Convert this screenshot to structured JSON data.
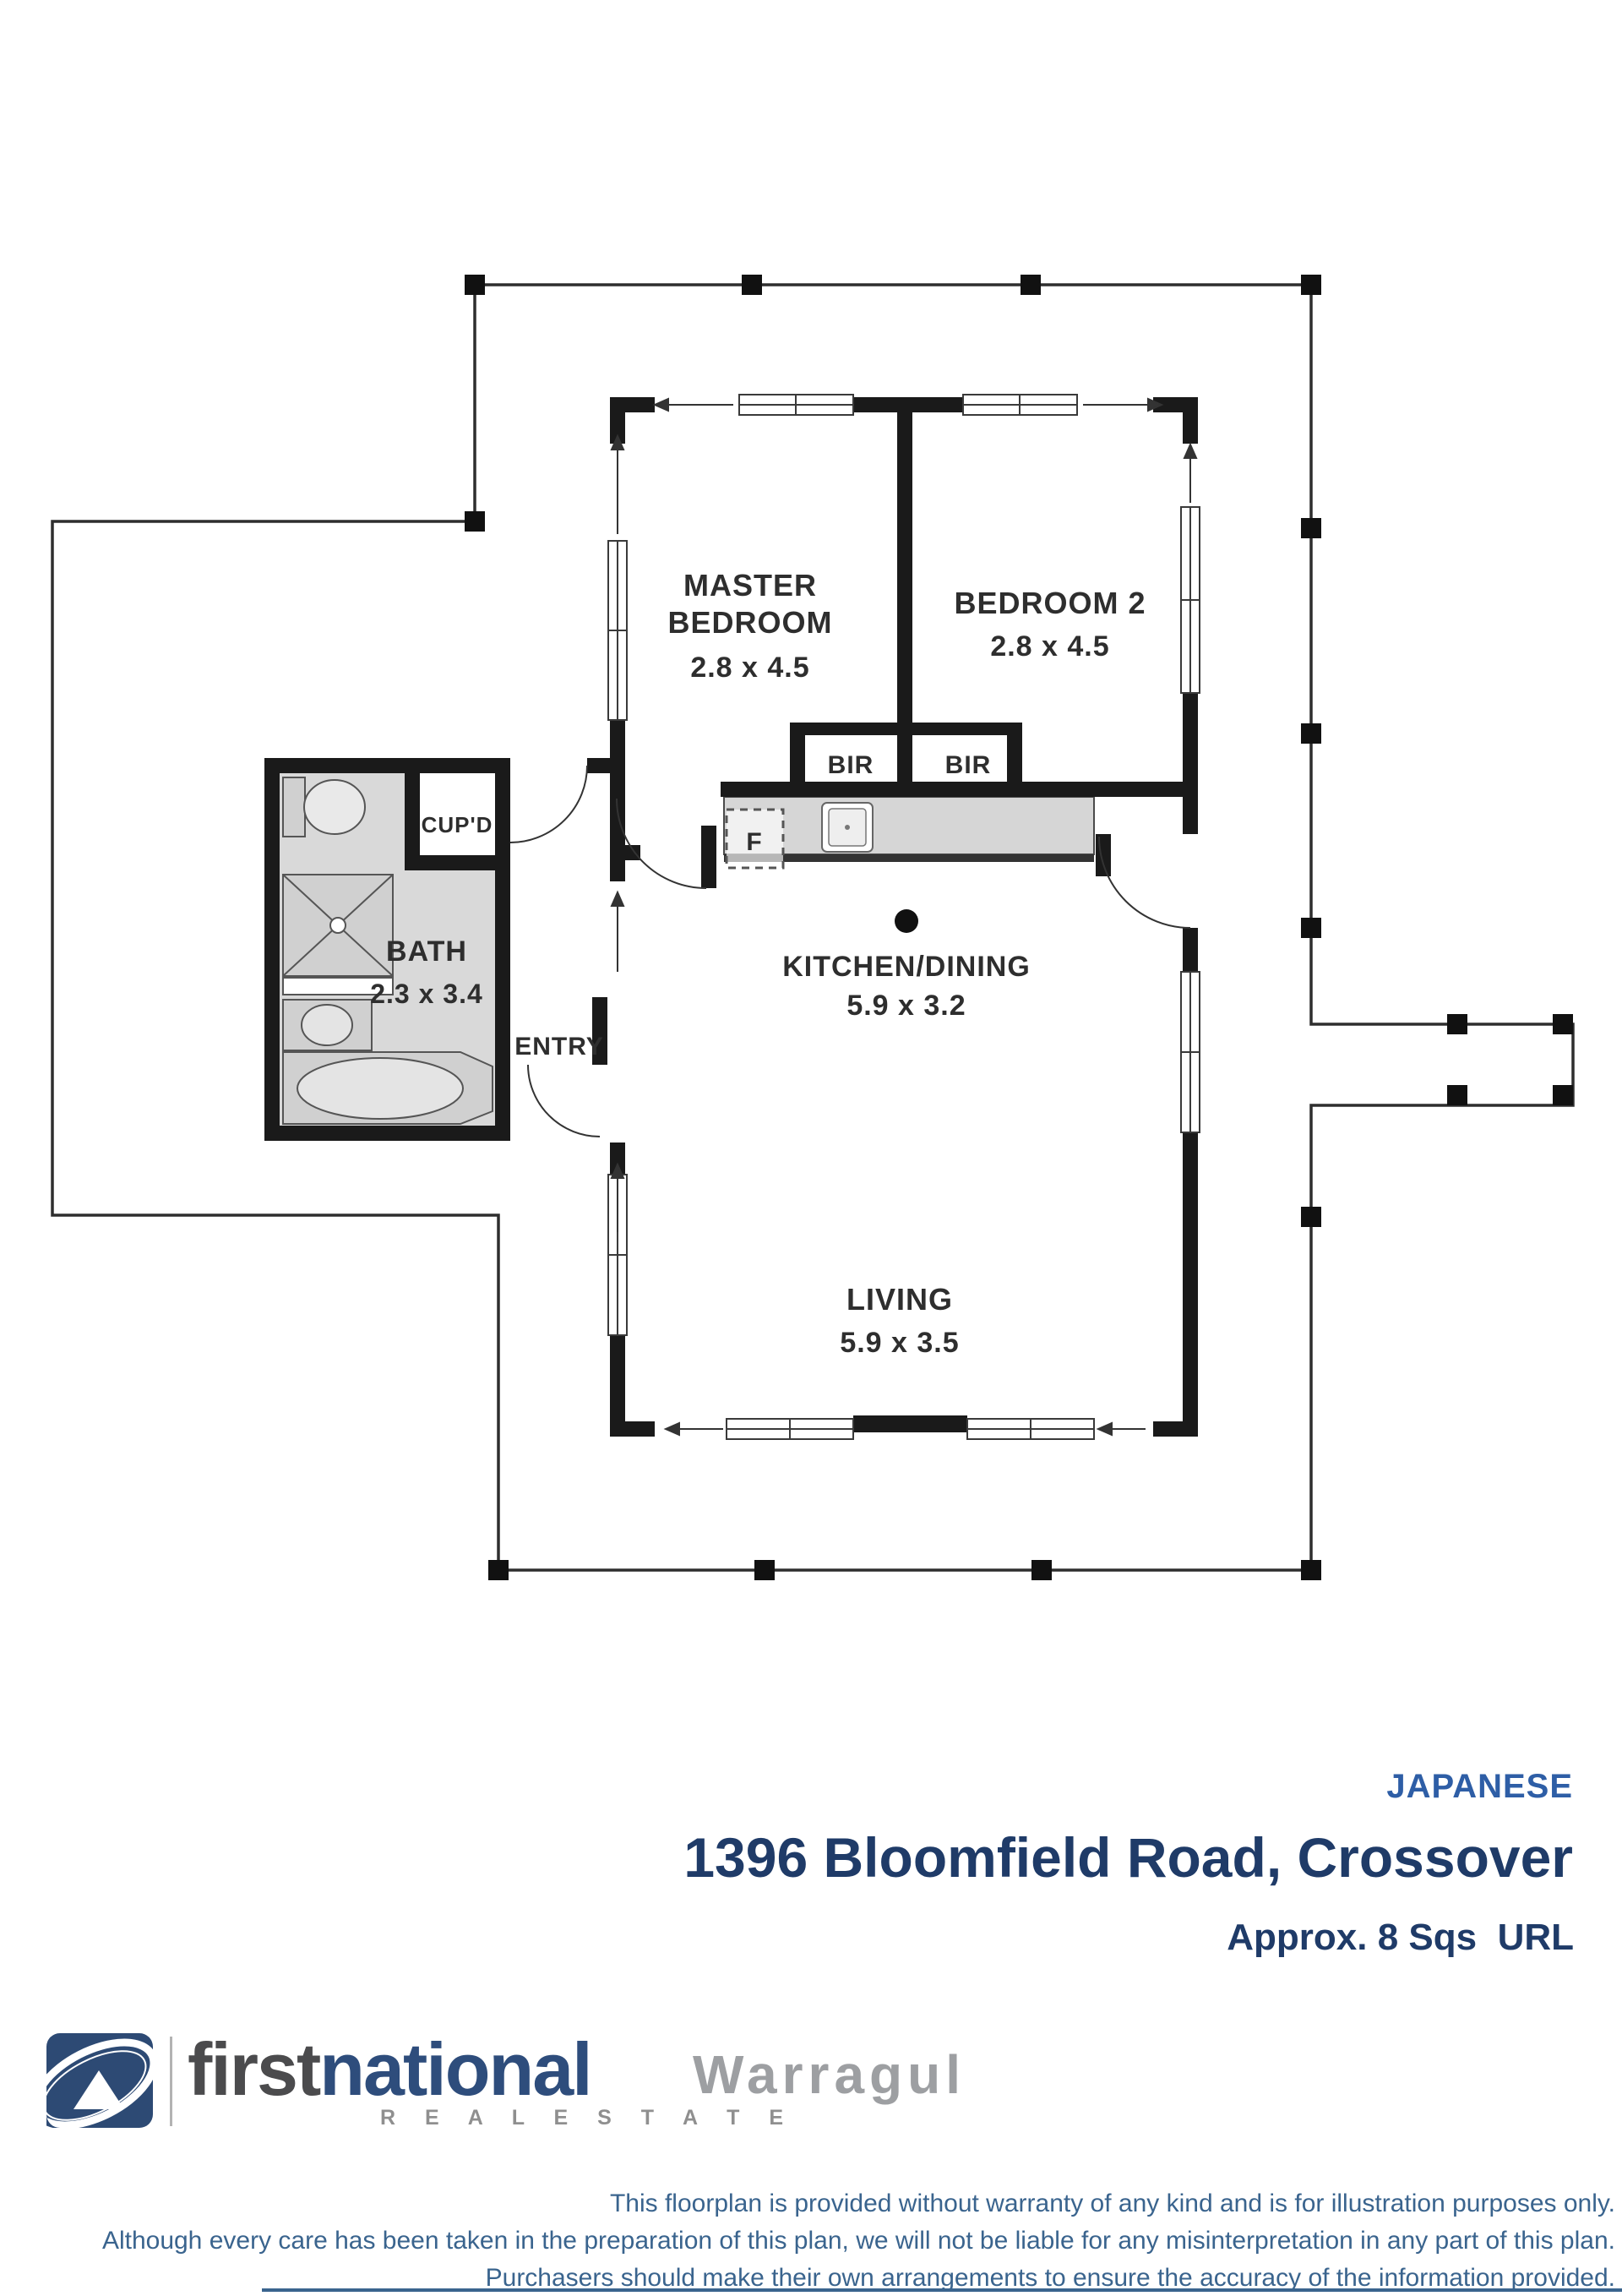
{
  "plan": {
    "rooms": {
      "master_bedroom": {
        "name_line1": "MASTER",
        "name_line2": "BEDROOM",
        "dims": "2.8 x 4.5"
      },
      "bedroom2": {
        "name": "BEDROOM 2",
        "dims": "2.8 x 4.5"
      },
      "bath": {
        "name": "BATH",
        "dims": "2.3 x 3.4"
      },
      "kitchen_dining": {
        "name": "KITCHEN/DINING",
        "dims": "5.9 x 3.2"
      },
      "living": {
        "name": "LIVING",
        "dims": "5.9 x 3.5"
      },
      "entry": {
        "name": "ENTRY"
      },
      "cupboard": {
        "name": "CUP'D"
      },
      "robe_left": {
        "name": "BIR"
      },
      "robe_right": {
        "name": "BIR"
      },
      "fridge": {
        "name": "F"
      }
    }
  },
  "listing": {
    "style_tag": "JAPANESE",
    "address": "1396 Bloomfield Road, Crossover",
    "size_note": "Approx. 8 Sqs  URL"
  },
  "branding": {
    "brand_first": "first",
    "brand_national": "national",
    "brand_sub": "R E A L   E S T A T E",
    "office": "Warragul"
  },
  "disclaimer": {
    "line1": "This floorplan is provided without warranty of any kind and is for illustration purposes only.",
    "line2": "Although every care has been taken in the preparation of this plan, we will not be liable for any misinterpretation in any part of this plan.",
    "line3": "Purchasers should make their own arrangements to ensure the accuracy of the information provided."
  },
  "colors": {
    "wall": "#1a1a1a",
    "deck_line": "#2e2e2e",
    "bath_fill": "#d9d9d9",
    "counter_fill": "#d6d6d6",
    "accent_blue": "#2e5ea6",
    "navy": "#1f3b68",
    "disclaimer_blue": "#3a648e",
    "logo_navy": "#2d4a74",
    "brand_gray": "#4b4b4d",
    "brand_blue": "#2e4d7c",
    "office_gray": "#9d9fa2"
  }
}
